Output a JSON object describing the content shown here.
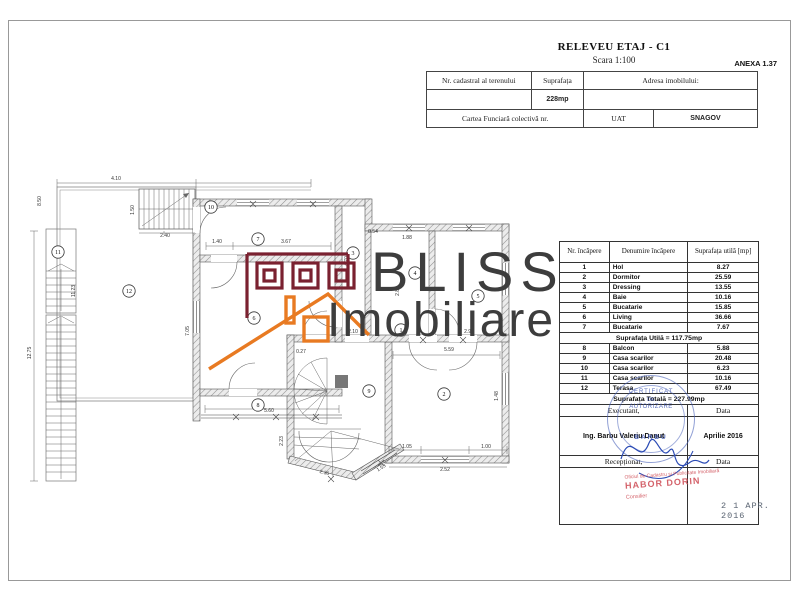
{
  "page": {
    "title": "RELEVEU ETAJ - C1",
    "subtitle": "Scara 1:100",
    "annex": "ANEXA 1.37"
  },
  "header_table": {
    "col1_label": "Nr. cadastral al terenului",
    "col2_label": "Suprafața",
    "col3_label": "Adresa imobilului:",
    "area_value": "228mp",
    "row3_label": "Cartea Funciară colectivă nr.",
    "uat_label": "UAT",
    "uat_value": "SNAGOV"
  },
  "room_table": {
    "headers": [
      "Nr. încăpere",
      "Denumire încăpere",
      "Suprafața utilă [mp]"
    ],
    "rows": [
      {
        "nr": "1",
        "name": "Hol",
        "area": "8.27"
      },
      {
        "nr": "2",
        "name": "Dormitor",
        "area": "25.59"
      },
      {
        "nr": "3",
        "name": "Dressing",
        "area": "13.55"
      },
      {
        "nr": "4",
        "name": "Baie",
        "area": "10.16"
      },
      {
        "nr": "5",
        "name": "Bucatarie",
        "area": "15.85"
      },
      {
        "nr": "6",
        "name": "Living",
        "area": "36.66"
      },
      {
        "nr": "7",
        "name": "Bucatarie",
        "area": "7.67"
      },
      {
        "nr": "8",
        "name": "Balcon",
        "area": "5.88"
      },
      {
        "nr": "9",
        "name": "Casa scarilor",
        "area": "20.48"
      },
      {
        "nr": "10",
        "name": "Casa scarilor",
        "area": "6.23"
      },
      {
        "nr": "11",
        "name": "Casa scarilor",
        "area": "10.16"
      },
      {
        "nr": "12",
        "name": "Terasa",
        "area": "67.49"
      }
    ],
    "utila_summary": "Suprafața Utilă = 117.75mp",
    "totala_summary": "Suprafața Totală = 227.99mp",
    "executant_label": "Executant,",
    "data_label": "Data",
    "executant_name": "Ing. Barbu Valeriu Danut",
    "executant_date": "Aprilie 2016",
    "receptionat_label": "Recepționat,",
    "data_label2": "Data"
  },
  "stamps": {
    "blue": {
      "line1": "CERTIFICAT",
      "line2": "DE",
      "line3": "AUTORIZARE",
      "name": "BARBU",
      "color": "#3c54b0"
    },
    "red": {
      "line1": "Oficiul de Cadastru și Publicitate Imobiliară",
      "line2": "HABOR DORIN",
      "line3": "Consilier",
      "color": "#cc4450"
    },
    "date_stamp": "2 1 APR. 2016"
  },
  "watermark": {
    "line1": "BLISS",
    "line2": "Imobiliare",
    "text_color": "#3d3d3d",
    "brand_dark_red": "#7a2130",
    "brand_orange": "#e87a22"
  },
  "plan": {
    "rooms": [
      {
        "nr": "1",
        "x": 400,
        "y": 329
      },
      {
        "nr": "2",
        "x": 443,
        "y": 393
      },
      {
        "nr": "3",
        "x": 352,
        "y": 252
      },
      {
        "nr": "4",
        "x": 414,
        "y": 272
      },
      {
        "nr": "5",
        "x": 477,
        "y": 295
      },
      {
        "nr": "6",
        "x": 253,
        "y": 317
      },
      {
        "nr": "7",
        "x": 257,
        "y": 238
      },
      {
        "nr": "8",
        "x": 257,
        "y": 404
      },
      {
        "nr": "9",
        "x": 368,
        "y": 390
      },
      {
        "nr": "10",
        "x": 210,
        "y": 206
      },
      {
        "nr": "11",
        "x": 57,
        "y": 251
      },
      {
        "nr": "12",
        "x": 128,
        "y": 290
      }
    ],
    "dimensions": [
      {
        "t": "4.10",
        "x": 115,
        "y": 179
      },
      {
        "t": "2.40",
        "x": 164,
        "y": 236
      },
      {
        "t": "1.50",
        "x": 133,
        "y": 209,
        "r": -90
      },
      {
        "t": "8.50",
        "x": 40,
        "y": 200,
        "r": -90
      },
      {
        "t": "11.23",
        "x": 74,
        "y": 290,
        "r": -90
      },
      {
        "t": "12.75",
        "x": 30,
        "y": 352,
        "r": -90
      },
      {
        "t": "1.40",
        "x": 216,
        "y": 242
      },
      {
        "t": "3.67",
        "x": 285,
        "y": 242
      },
      {
        "t": "4.70",
        "x": 347,
        "y": 260,
        "r": -90
      },
      {
        "t": "7.05",
        "x": 188,
        "y": 330,
        "r": -90
      },
      {
        "t": "2.88",
        "x": 398,
        "y": 290,
        "r": -90
      },
      {
        "t": "1.88",
        "x": 406,
        "y": 238
      },
      {
        "t": "0.54",
        "x": 372,
        "y": 232
      },
      {
        "t": "2.96",
        "x": 468,
        "y": 332
      },
      {
        "t": "5.59",
        "x": 448,
        "y": 350
      },
      {
        "t": "1.48",
        "x": 497,
        "y": 395,
        "r": -90
      },
      {
        "t": "5.60",
        "x": 268,
        "y": 411
      },
      {
        "t": "0.27",
        "x": 300,
        "y": 352
      },
      {
        "t": "2.10",
        "x": 352,
        "y": 332
      },
      {
        "t": "1.05",
        "x": 406,
        "y": 447
      },
      {
        "t": "1.00",
        "x": 485,
        "y": 447
      },
      {
        "t": "2.52",
        "x": 444,
        "y": 470
      },
      {
        "t": "2.23",
        "x": 282,
        "y": 440,
        "r": -90
      },
      {
        "t": "2.36",
        "x": 323,
        "y": 473,
        "r": 14
      },
      {
        "t": "1.53",
        "x": 381,
        "y": 468,
        "r": -32
      }
    ]
  }
}
